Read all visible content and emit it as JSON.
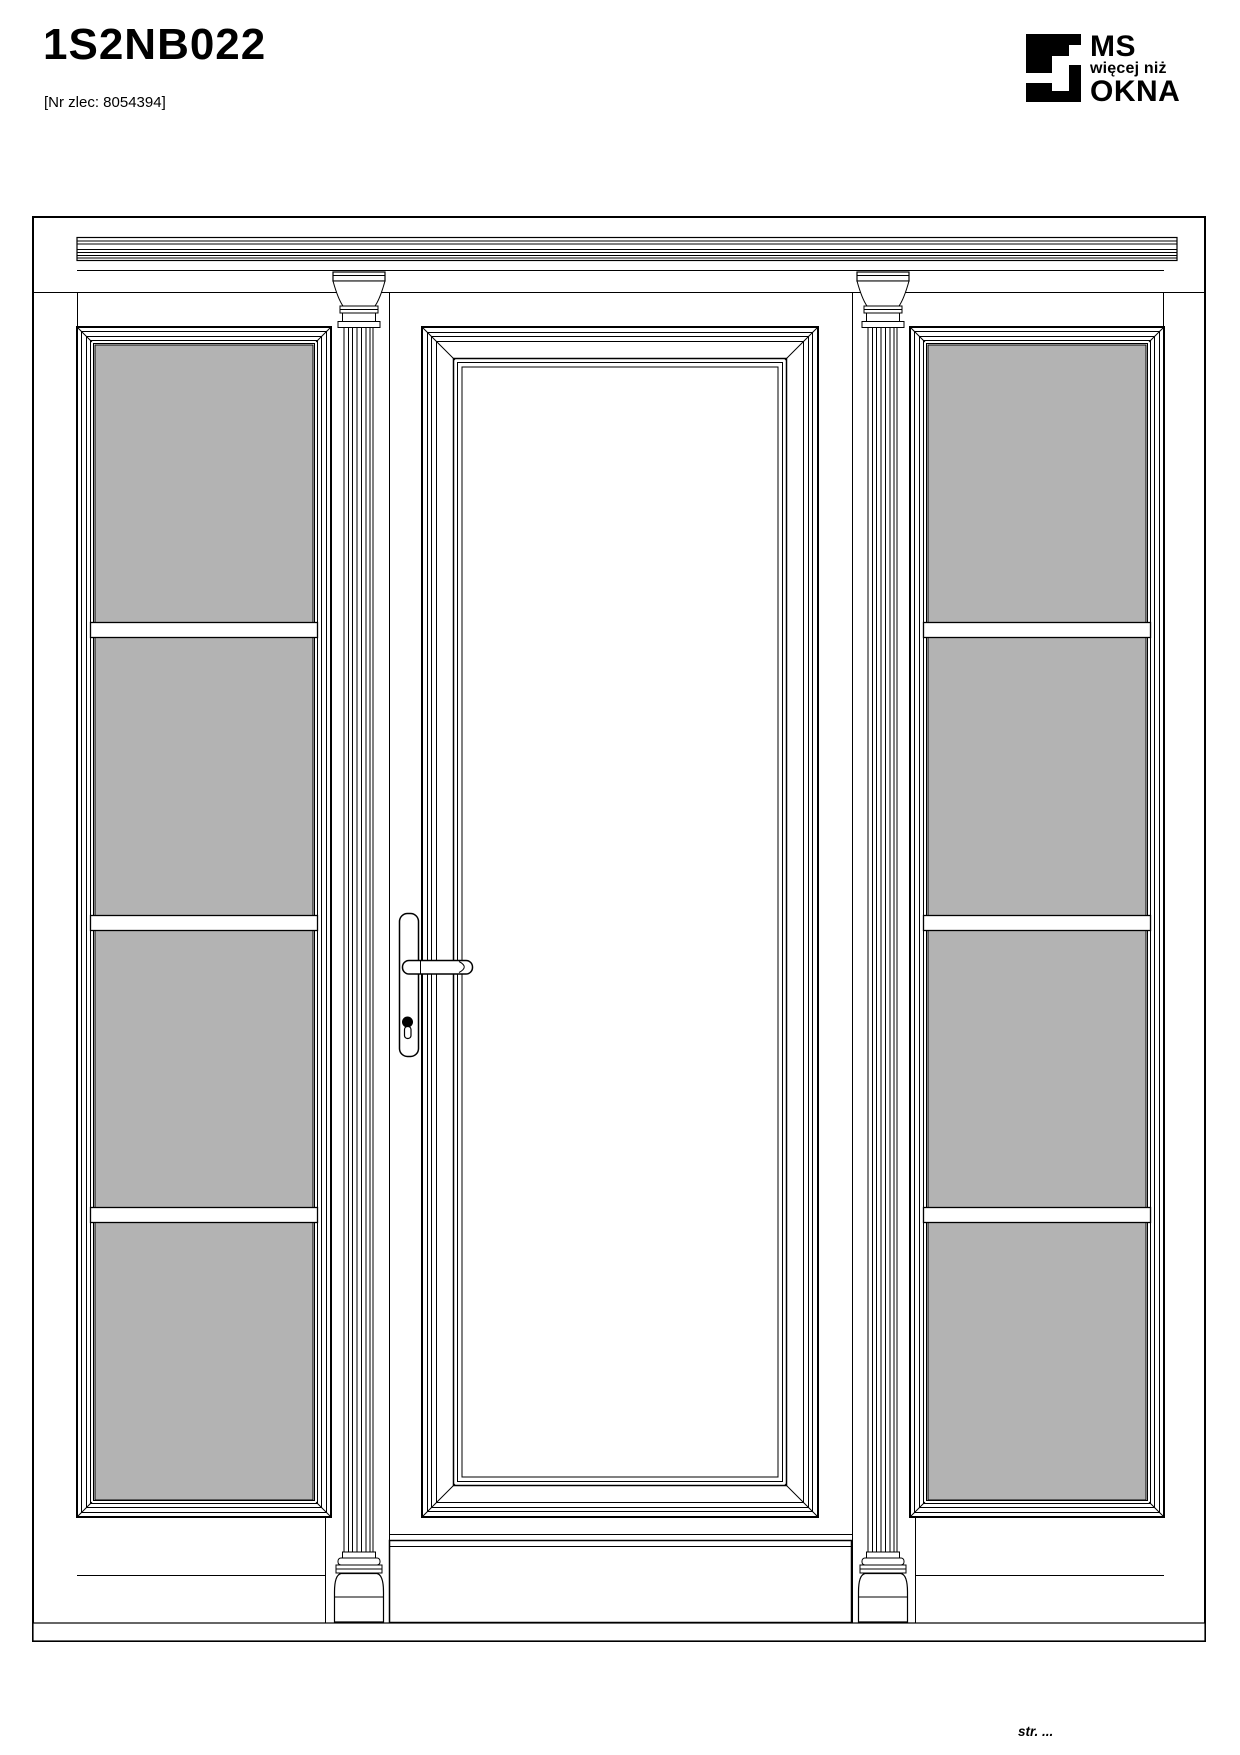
{
  "header": {
    "title": "1S2NB022",
    "order_ref": "[Nr zlec: 8054394]"
  },
  "logo": {
    "line1": "MS",
    "line2": "więcej niż",
    "line3": "OKNA"
  },
  "footer": {
    "page_label": "str. ..."
  },
  "drawing": {
    "type": "door-elevation",
    "elements": {
      "sidelights": 2,
      "frosted_panes_per_sidelight": 4,
      "glazing_bars_per_sidelight": 3,
      "columns": 2,
      "door_leaves": 1
    },
    "colors": {
      "line": "#000000",
      "frosted_glass": "#b3b3b3",
      "clear_glass": "#ffffff",
      "paper": "#ffffff"
    }
  }
}
